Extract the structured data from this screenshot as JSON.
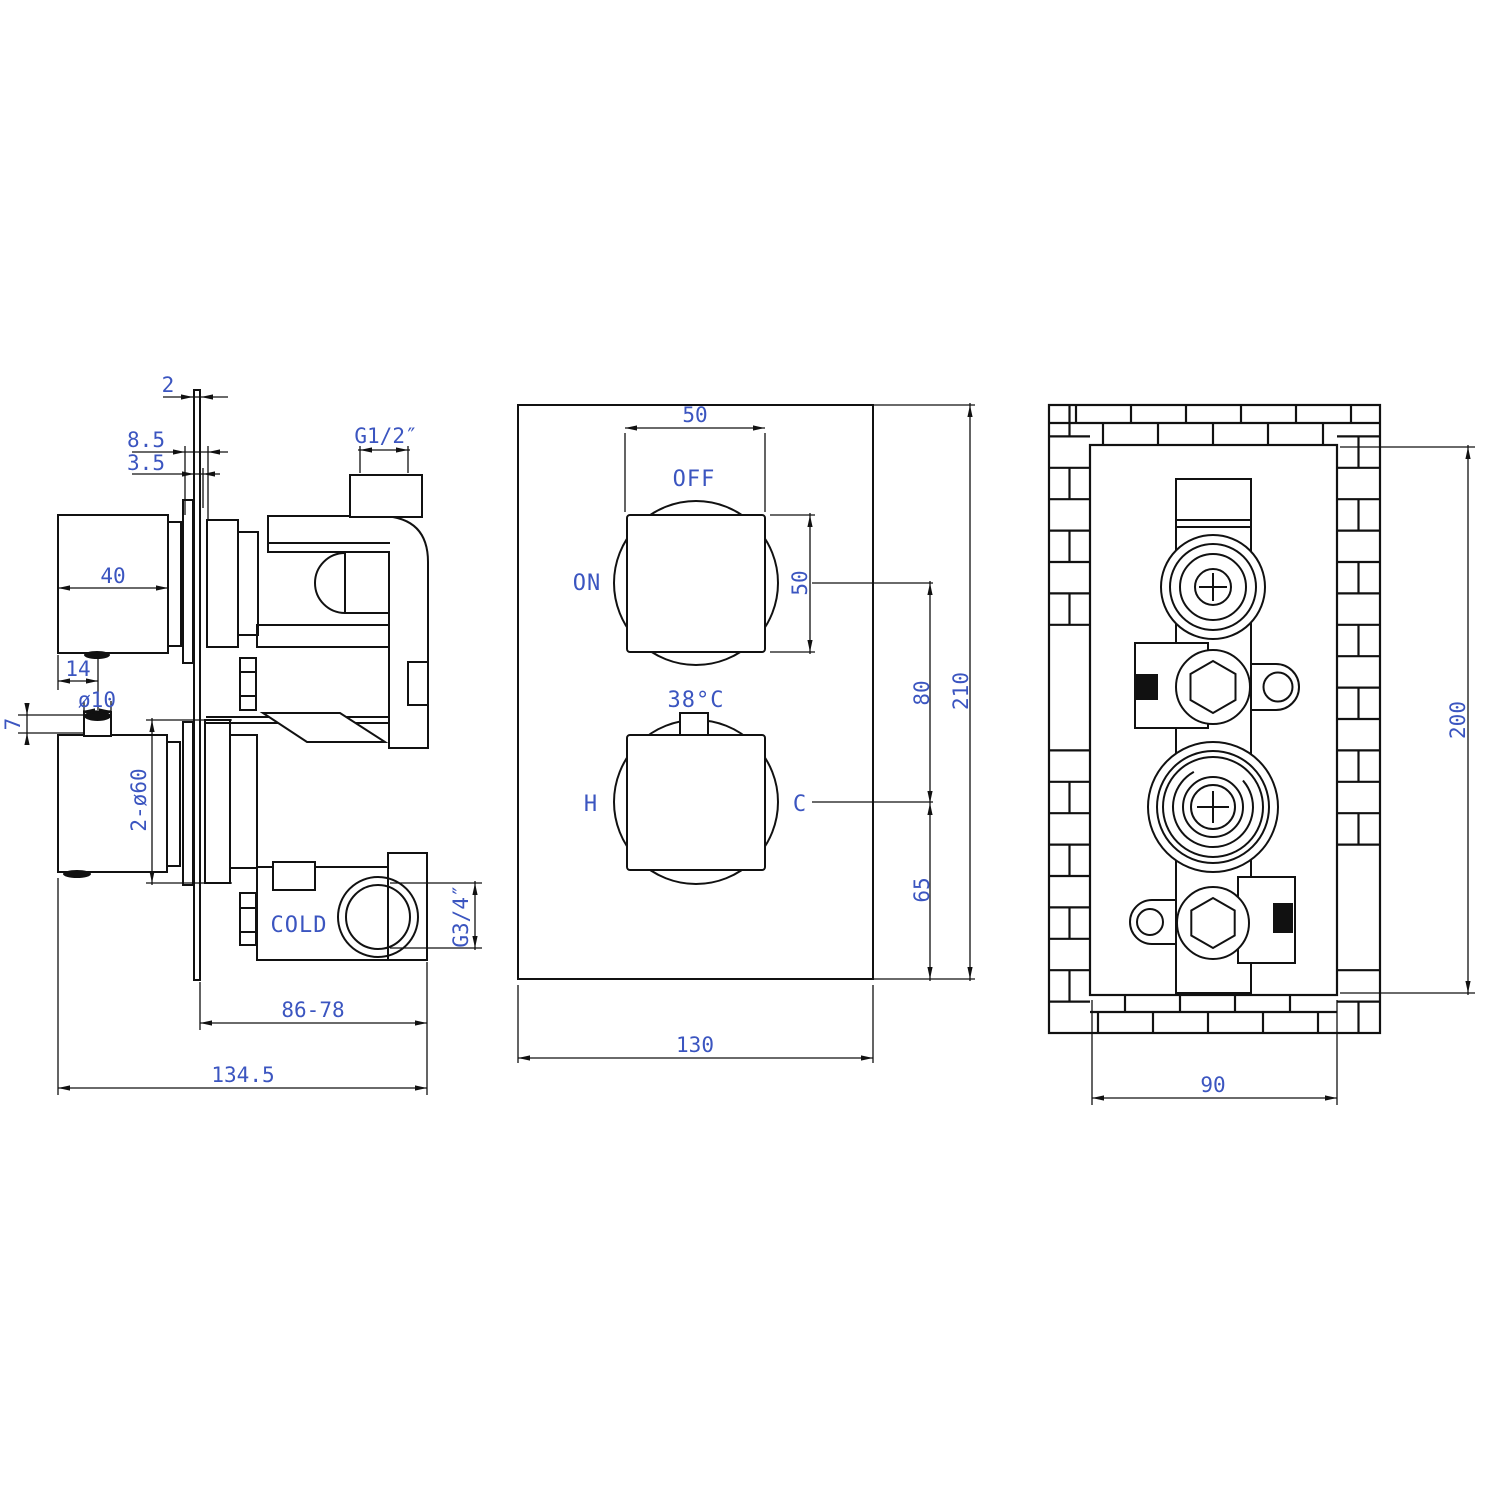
{
  "title": "Thermostatic shower valve technical drawing",
  "colors": {
    "line": "#111111",
    "label": "#3b55c0",
    "background": "#ffffff"
  },
  "views": {
    "side": {
      "dim_plate_thickness": "2",
      "dim_8_5": "8.5",
      "dim_3_5": "3.5",
      "thread_top_outlet": "G1/2″",
      "dim_knob_depth": "40",
      "dim_14": "14",
      "dim_pin_diameter": "ø10",
      "dim_7": "7",
      "dim_flange_diameter": "2-ø60",
      "cold_inlet_label": "COLD",
      "thread_bottom_outlet": "G3/4″",
      "dim_body_depth": "86-78",
      "dim_total_depth": "134.5"
    },
    "front": {
      "dim_knob_width": "50",
      "off_label": "OFF",
      "on_label": "ON",
      "dim_knob_height": "50",
      "temp_label": "38°C",
      "hot_label": "H",
      "cold_label": "C",
      "dim_knob_spacing": "80",
      "dim_bottom_offset": "65",
      "dim_plate_height": "210",
      "dim_plate_width": "130"
    },
    "back": {
      "dim_recess_height": "200",
      "dim_recess_width": "90"
    }
  }
}
